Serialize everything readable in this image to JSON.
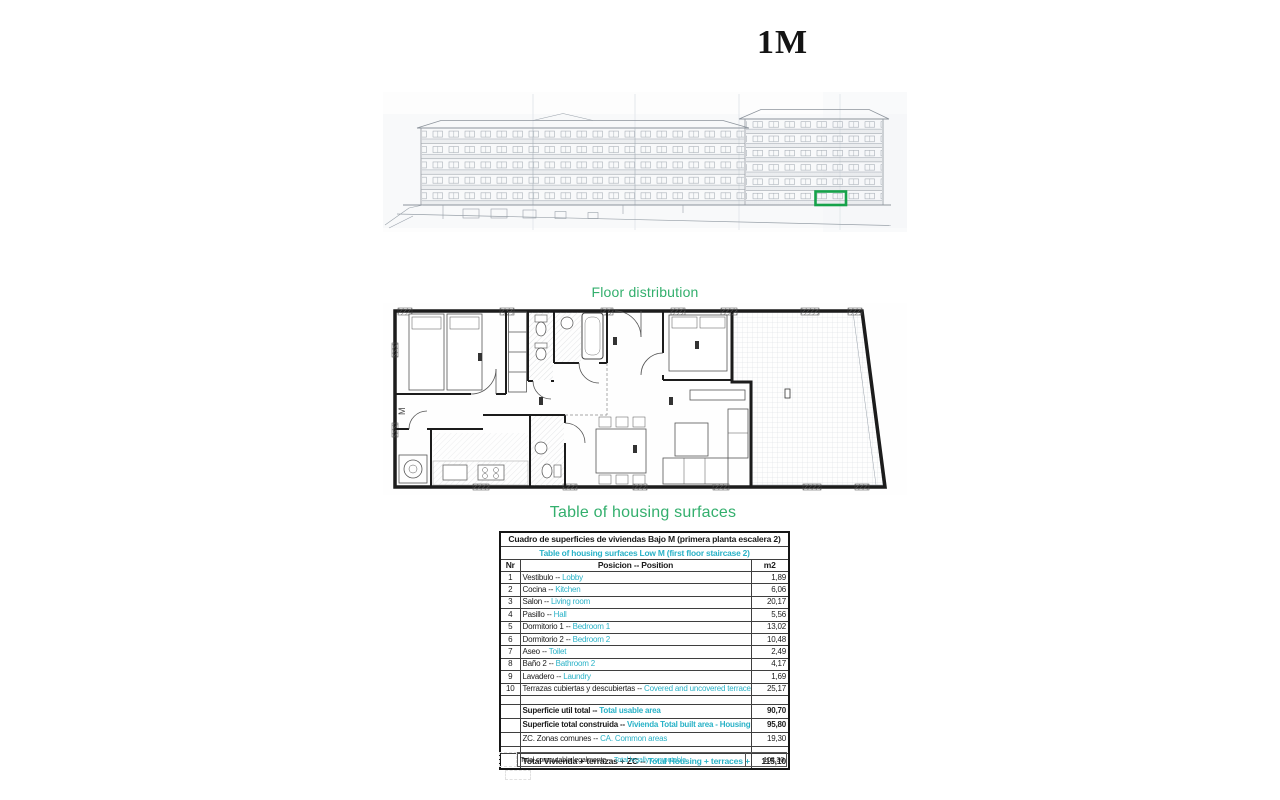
{
  "page": {
    "title": "1M"
  },
  "colors": {
    "accent_green": "#33af6d",
    "teal": "#29b2c7",
    "highlight_green": "#16a24a"
  },
  "elevation": {
    "description": "building-elevation-drawing",
    "highlighted_unit": "green-box"
  },
  "floor_plan": {
    "label": "Floor distribution",
    "m_label": "M"
  },
  "surfaces": {
    "title": "Table of housing surfaces",
    "header_es": "Cuadro de superficies de viviendas Bajo M (primera planta escalera 2)",
    "header_en": "Table of housing surfaces Low M  (first floor staircase 2)",
    "columns": {
      "nr": "Nr",
      "position": "Posicion -- Position",
      "m2": "m2"
    },
    "rows": [
      {
        "nr": "1",
        "es": "Vestibulo -- ",
        "en": "Lobby",
        "m2": "1,89"
      },
      {
        "nr": "2",
        "es": "Cocina -- ",
        "en": "Kitchen",
        "m2": "6,06"
      },
      {
        "nr": "3",
        "es": "Salon -- ",
        "en": "Living room",
        "m2": "20,17"
      },
      {
        "nr": "4",
        "es": "Pasillo -- ",
        "en": "Hall",
        "m2": "5,56"
      },
      {
        "nr": "5",
        "es": "Dormitorio 1 -- ",
        "en": "Bedroom 1",
        "m2": "13,02"
      },
      {
        "nr": "6",
        "es": "Dormitorio 2 -- ",
        "en": "Bedroom 2",
        "m2": "10,48"
      },
      {
        "nr": "7",
        "es": "Aseo -- ",
        "en": "Toilet",
        "m2": "2,49"
      },
      {
        "nr": "8",
        "es": "Baño 2 -- ",
        "en": "Bathroom 2",
        "m2": "4,17"
      },
      {
        "nr": "9",
        "es": "Lavadero -- ",
        "en": "Laundry",
        "m2": "1,69"
      },
      {
        "nr": "10",
        "es": "Terrazas cubiertas y descubiertas -- ",
        "en": "Covered and uncovered terraces",
        "m2": "25,17"
      }
    ],
    "summary": [
      {
        "es": "Superficie util total -- ",
        "en": "Total usable area",
        "m2": "90,70",
        "bold": true
      },
      {
        "es": "Superficie total construida -- ",
        "en": "Vivienda Total built area - Housing",
        "m2": "95,80",
        "bold": true
      },
      {
        "es": "ZC. Zonas comunes  -- ",
        "en": "CA. Common areas",
        "m2": "19,30",
        "bold": false
      }
    ],
    "total": {
      "es": "Total Vivienda + terrazas + ZC  -- ",
      "en": "Total Housing + terraces + CA",
      "m2": "115,10"
    },
    "legal": {
      "es": "Total computable legalmente -- ",
      "en": "Total legally computable",
      "m2": "103,30"
    }
  }
}
